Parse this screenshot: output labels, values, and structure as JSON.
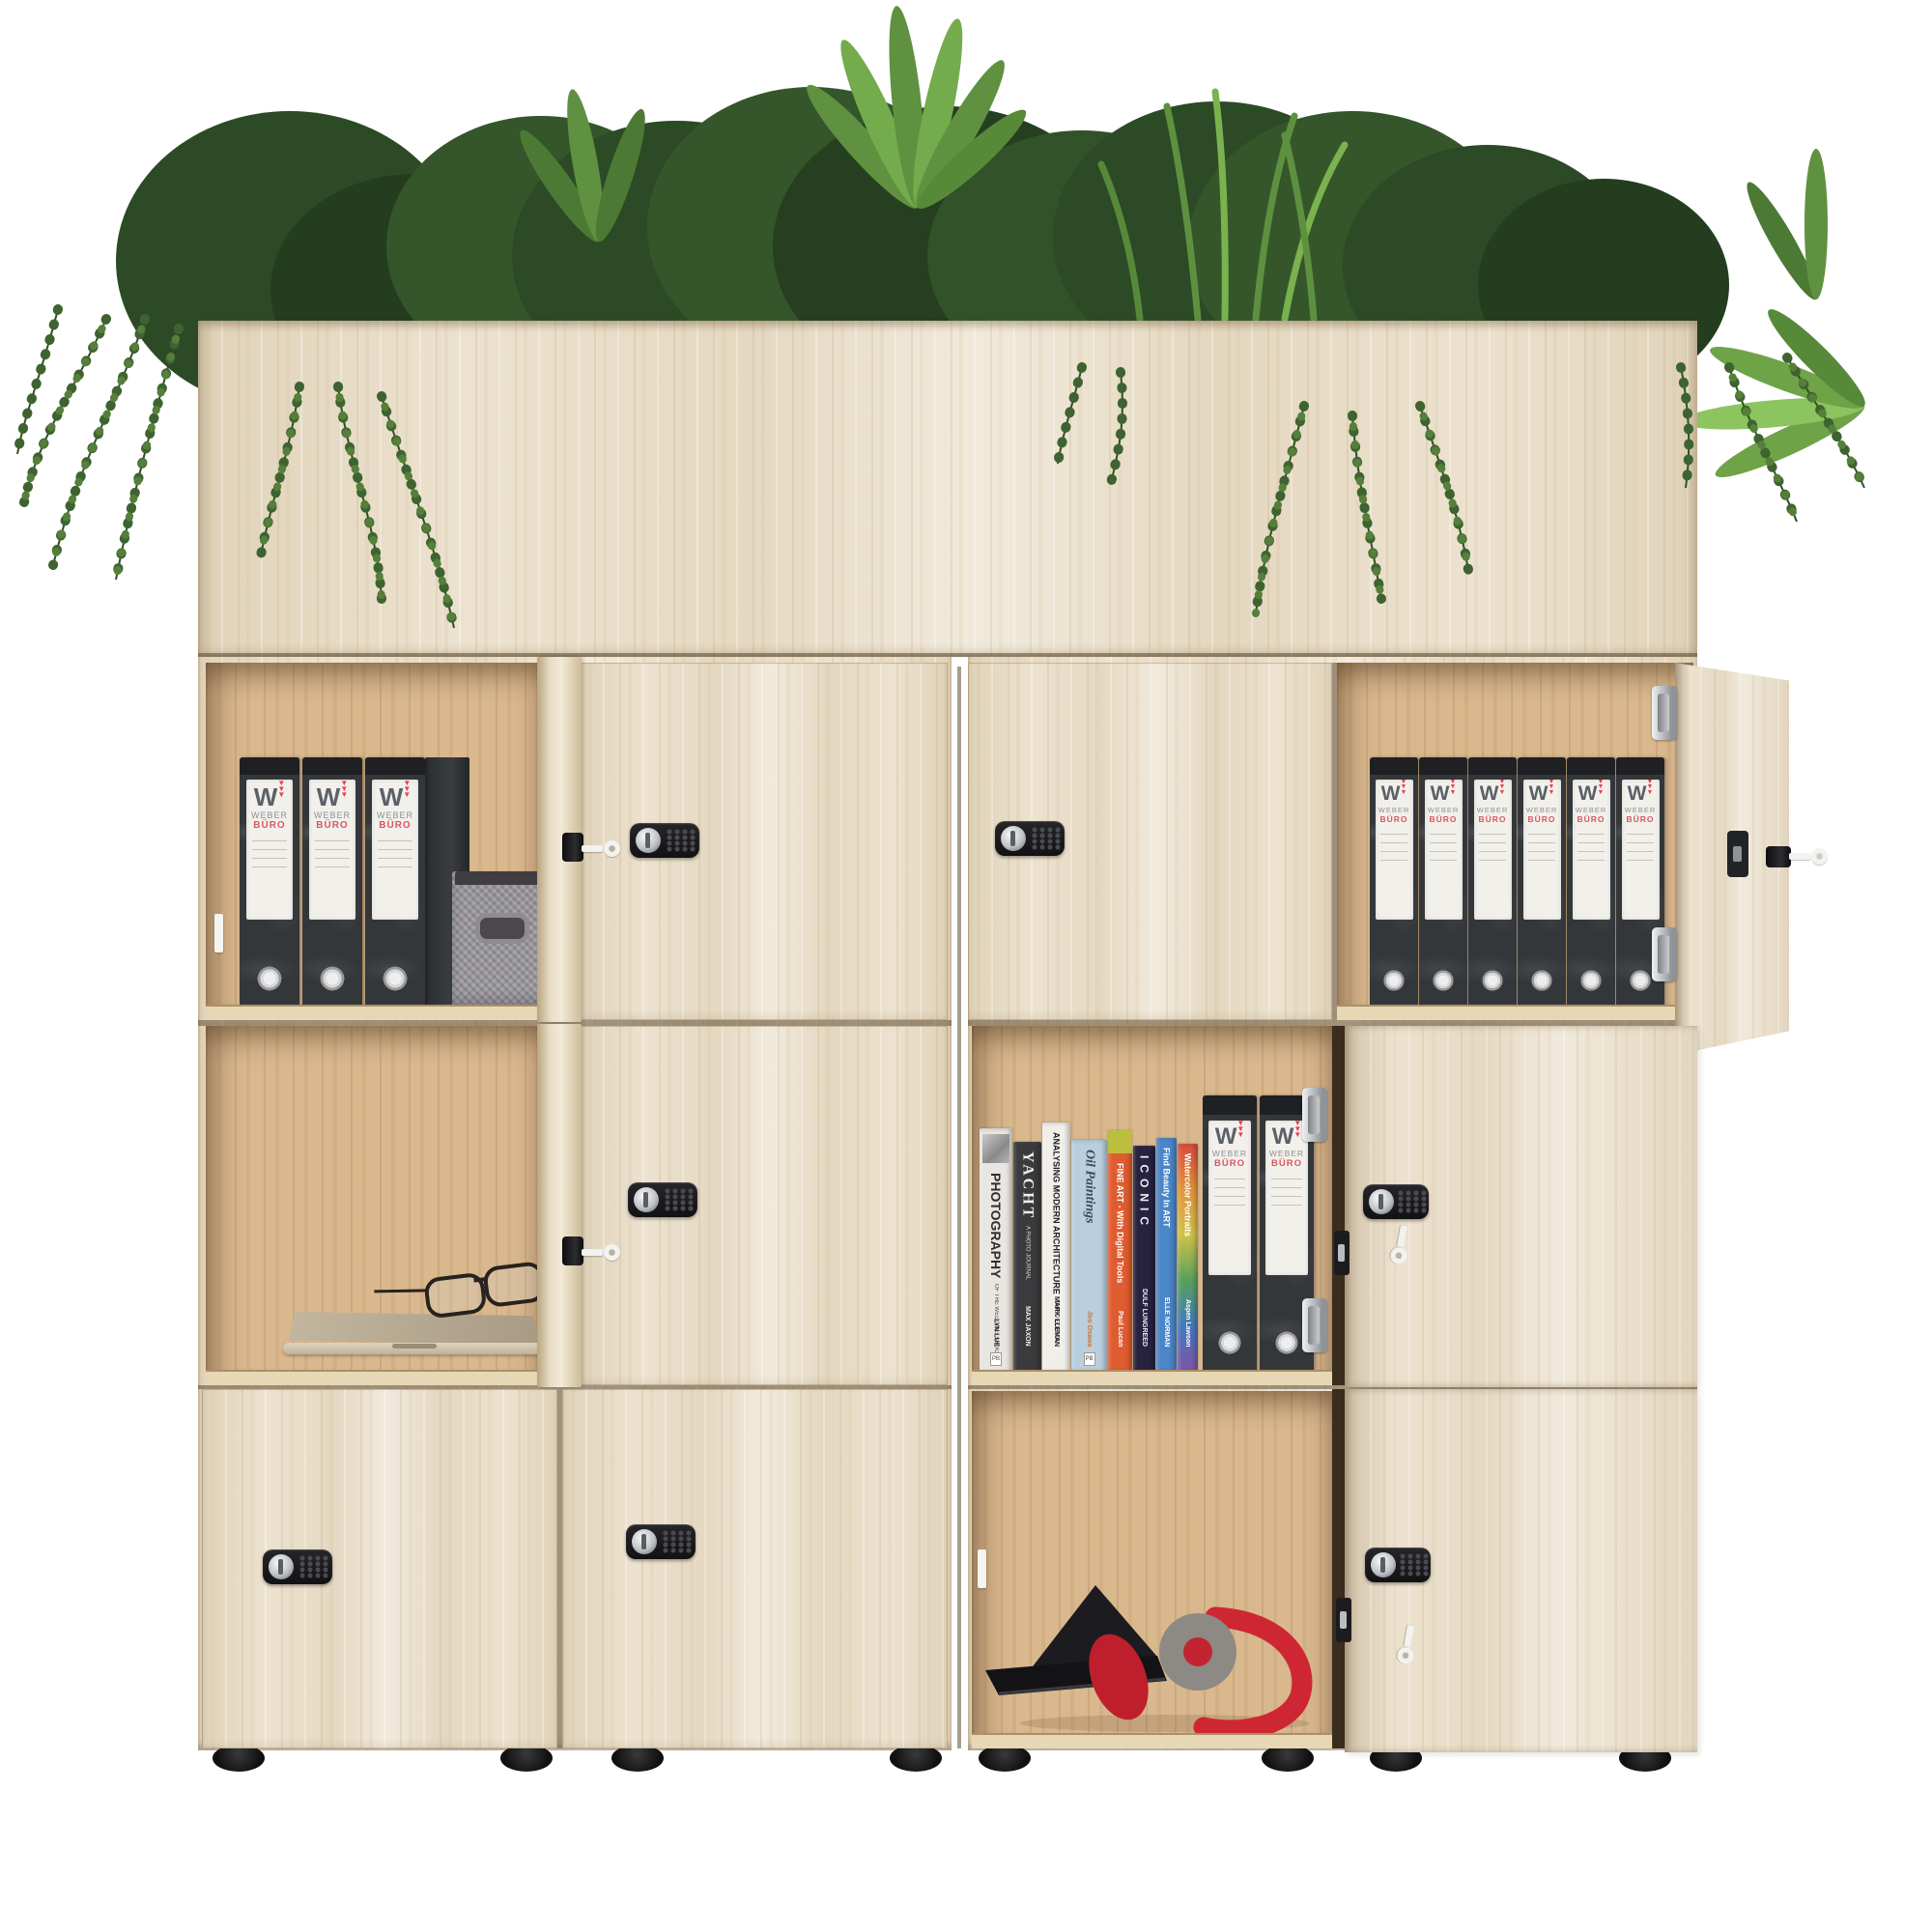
{
  "scene": {
    "type": "product-render",
    "subject": "Wooden office smart-locker cabinet with planter top, twelve compartments, combination locks, and styled contents",
    "background_color": "#ffffff"
  },
  "branding": {
    "binder_label_top": "WEBER",
    "binder_label_bottom": "BÜRO",
    "binder_logo_letter": "W",
    "binder_triangles": "▼"
  },
  "binder_groups": [
    {
      "id": "top-left",
      "compartment": "row1-col1-open",
      "count": 3
    },
    {
      "id": "top-right",
      "compartment": "row1-col4-open",
      "count": 6
    },
    {
      "id": "middle-right",
      "compartment": "row2-col3-open",
      "count": 2
    }
  ],
  "books": [
    {
      "title": "PHOTOGRAPHY",
      "subtitle": "OF THE WEDDING SHOOT",
      "author": "LYN LUE",
      "spine_color": "#e9e6e1",
      "text_color": "#2d2d2d",
      "style": "photo"
    },
    {
      "title": "YACHT",
      "subtitle": "A PHOTO JOURNAL",
      "author": "MAX JAXON",
      "spine_color": "#3b3b3d",
      "text_color": "#f0efec",
      "style": "serif"
    },
    {
      "title": "ANALYSING MODERN ARCHITECTURE",
      "subtitle": "THIRD EDITION",
      "author": "MARK LLEMAN",
      "spine_color": "#f1efea",
      "text_color": "#1c1c1c",
      "style": "caps"
    },
    {
      "title": "Oil Paintings",
      "subtitle": "",
      "author": "Jiro Osawa",
      "spine_color": "#bacfdd",
      "text_color": "#3c4c5e",
      "author_color": "#d0752f",
      "style": "serif-italic"
    },
    {
      "title": "FINE ART - With Digital Tools",
      "subtitle": "",
      "author": "Paul Lucan",
      "spine_color": "#df5c31",
      "top_band_color": "#bcbf3e",
      "text_color": "#ffffff",
      "style": "band"
    },
    {
      "title": "ICONIC",
      "subtitle": "",
      "author": "DULF LUNGREED",
      "spine_color": "#262240",
      "text_color": "#eeeeee",
      "style": "letterspaced"
    },
    {
      "title": "Find Beauty In ART",
      "subtitle": "",
      "author": "ELLE NORMAN",
      "spine_color": "#4a86c8",
      "text_color": "#ffffff",
      "style": "plain"
    },
    {
      "title": "Watercolor Portraits",
      "subtitle": "",
      "author": "Aspen Lawson",
      "spine_colors": [
        "#d84a3e",
        "#e2953b",
        "#cfc14a",
        "#58a05c",
        "#4379bd",
        "#7e54a6"
      ],
      "text_color": "#ffffff",
      "style": "rainbow"
    }
  ],
  "loose_items": [
    "gray-fabric-storage-cube",
    "silver-laptop-closed",
    "black-round-glasses",
    "black-tablet-folio",
    "red-gray-headphones"
  ],
  "hardware": {
    "combination_locks_front": 5,
    "combination_locks_on_open_door_backs": 2,
    "edge_key_cylinders": 3,
    "keys_visible": 6,
    "hinges_visible": 4,
    "white_catch_plates": 2,
    "feet": 8
  },
  "structure": {
    "planter_plants": [
      "ferns",
      "boxwood-bushes",
      "tall-grass",
      "hanging-ivy-vines"
    ],
    "rows": 3,
    "columns": 4,
    "open_compartments": 5,
    "closed_doors": 5,
    "open_doors": 5
  },
  "palette": {
    "wood_front": "#ece2cf",
    "wood_grain": "#c9ae85",
    "wood_interior": "#d9b88e",
    "seam_dark": "#6e5a3c",
    "binder_body": "#34373a",
    "binder_label": "#f2f0eb",
    "brand_gray": "#5a6167",
    "brand_red": "#e8404e",
    "brand_red_text": "#d95761",
    "lock_black": "#1b1b1d",
    "chrome": "#c9cccf",
    "key_white": "#f2f2ef",
    "headphone_red": "#ce2733",
    "headphone_gray": "#8d8984",
    "plant_dark": "#253f20",
    "plant_mid": "#35562a",
    "plant_light": "#6fa348"
  }
}
